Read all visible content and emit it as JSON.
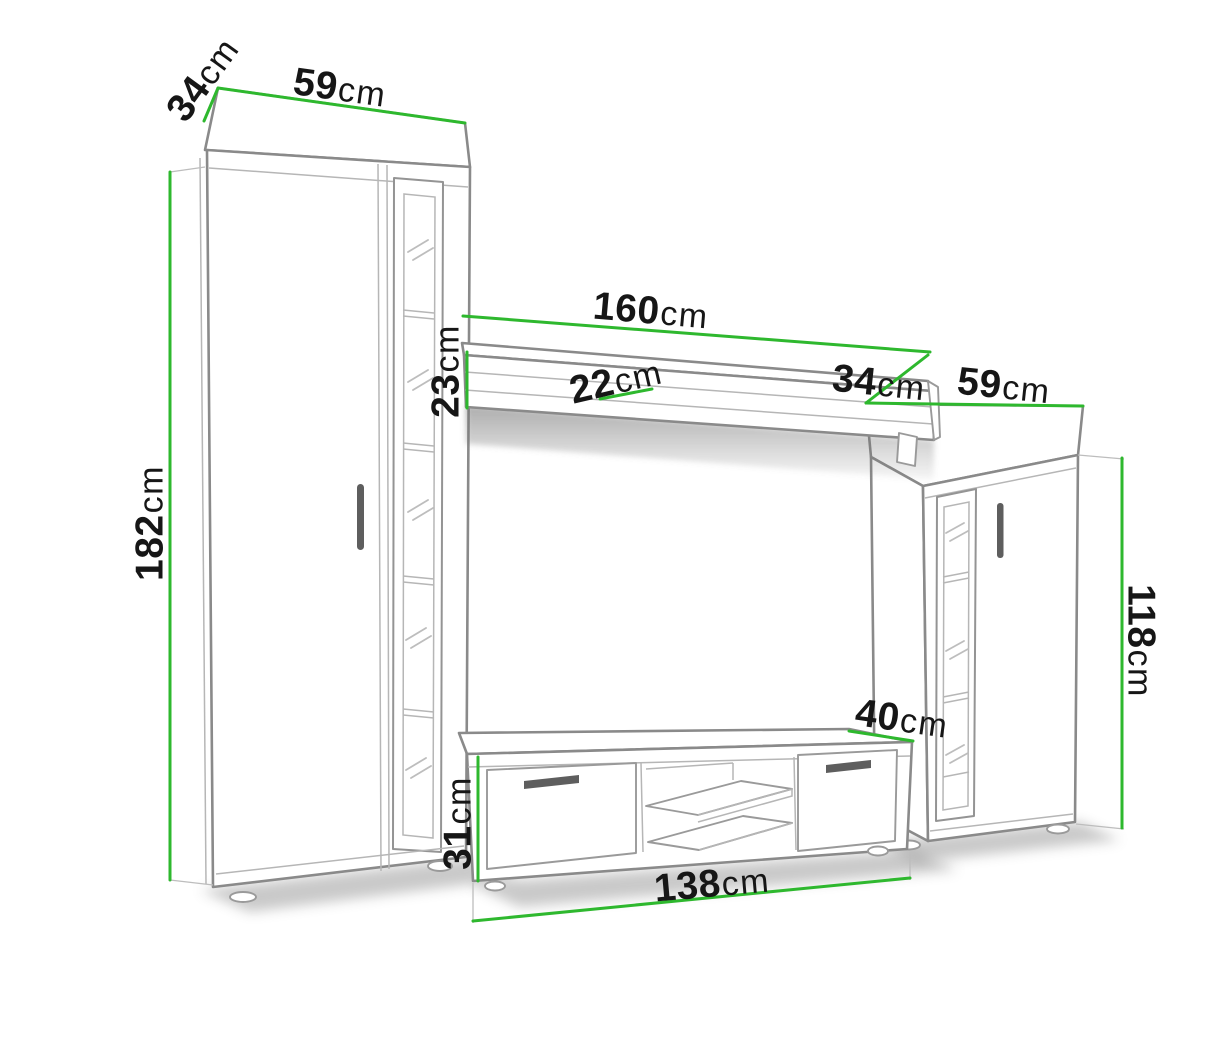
{
  "unit": "cm",
  "dimensions": {
    "left_cabinet_depth": {
      "value": "34",
      "unit": "cm"
    },
    "left_cabinet_width": {
      "value": "59",
      "unit": "cm"
    },
    "left_cabinet_height": {
      "value": "182",
      "unit": "cm"
    },
    "shelf_length": {
      "value": "160",
      "unit": "cm"
    },
    "shelf_height": {
      "value": "23",
      "unit": "cm"
    },
    "shelf_depth": {
      "value": "22",
      "unit": "cm"
    },
    "right_cabinet_depth": {
      "value": "34",
      "unit": "cm"
    },
    "right_cabinet_width": {
      "value": "59",
      "unit": "cm"
    },
    "right_cabinet_height": {
      "value": "118",
      "unit": "cm"
    },
    "tv_stand_depth": {
      "value": "40",
      "unit": "cm"
    },
    "tv_stand_height": {
      "value": "31",
      "unit": "cm"
    },
    "tv_stand_width": {
      "value": "138",
      "unit": "cm"
    }
  },
  "colors": {
    "dimension_line": "#2eb82e",
    "outline": "#8a8a8a",
    "label": "#161616",
    "background": "#ffffff",
    "handle": "#5e5e5e"
  }
}
